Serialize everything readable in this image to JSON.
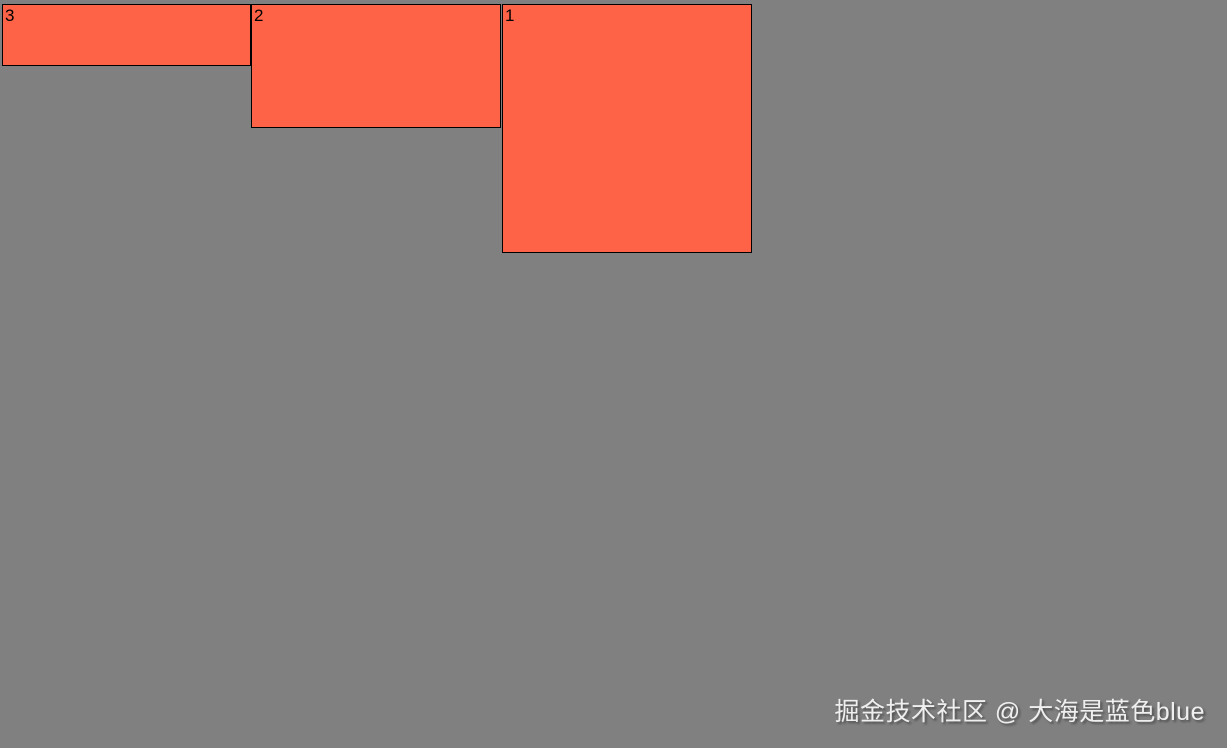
{
  "page": {
    "background_color": "#808080",
    "box_color": "#FF6347",
    "border_color": "#000000"
  },
  "boxes": [
    {
      "label": "3"
    },
    {
      "label": "2"
    },
    {
      "label": "1"
    }
  ],
  "watermark": {
    "text": "掘金技术社区 @ 大海是蓝色blue"
  }
}
